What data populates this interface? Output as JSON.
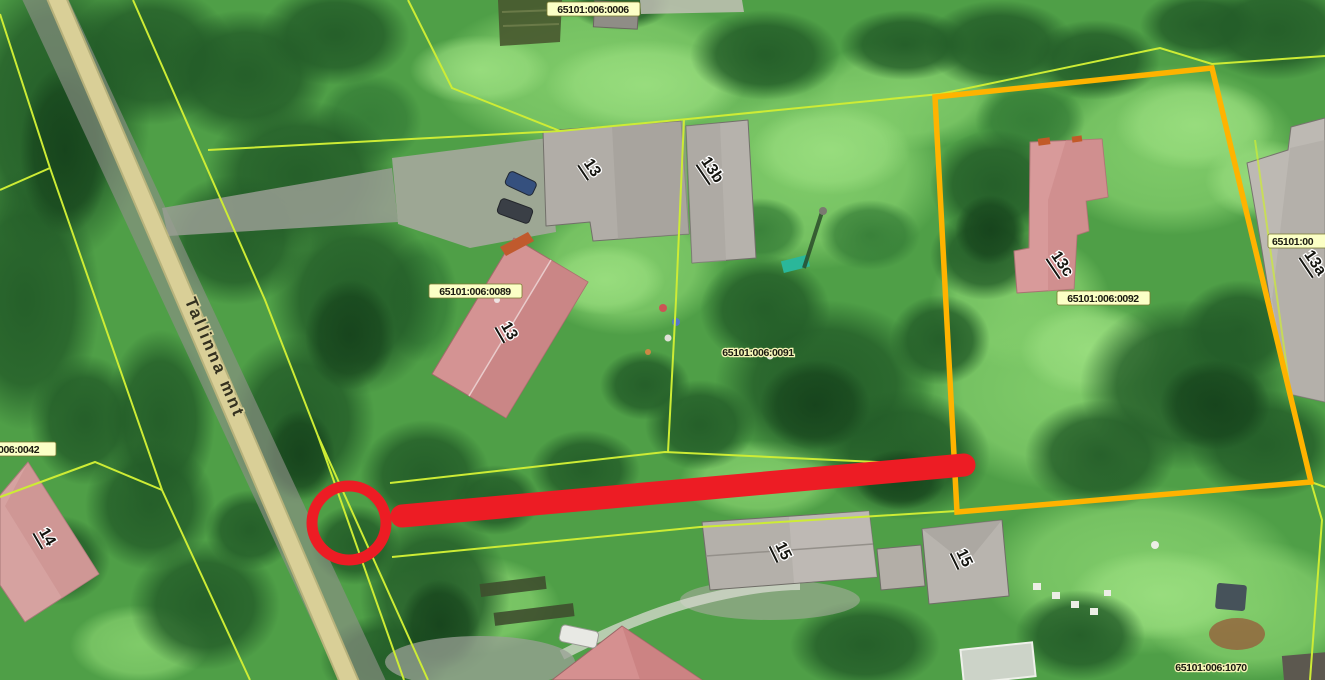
{
  "map": {
    "description": "Aerial cadastral map view (satellite imagery with parcel overlay)",
    "road": {
      "name": "Tallinna mnt"
    },
    "parcel_labels": [
      {
        "code": "65101:006:0006",
        "boxed": true,
        "x": 593,
        "y": 9
      },
      {
        "code": "65101:006:0089",
        "boxed": true,
        "x": 475,
        "y": 291
      },
      {
        "code": "65101:006:0091",
        "boxed": false,
        "x": 758,
        "y": 352
      },
      {
        "code": "65101:006:0092",
        "boxed": true,
        "x": 1103,
        "y": 298
      },
      {
        "code": "65101:00",
        "boxed": true,
        "x": 1295,
        "y": 241,
        "clipped": "right"
      },
      {
        "code": "65101:006:1070",
        "boxed": false,
        "x": 1211,
        "y": 666
      },
      {
        "code": "006:0042",
        "boxed": true,
        "x": 38,
        "y": 450,
        "clipped": "left"
      }
    ],
    "building_labels": [
      {
        "text": "13",
        "x": 592,
        "y": 168
      },
      {
        "text": "13b",
        "x": 712,
        "y": 170
      },
      {
        "text": "13",
        "x": 509,
        "y": 331
      },
      {
        "text": "13c",
        "x": 1062,
        "y": 264
      },
      {
        "text": "13a",
        "x": 1315,
        "y": 263
      },
      {
        "text": "15",
        "x": 783,
        "y": 551
      },
      {
        "text": "15",
        "x": 964,
        "y": 558
      },
      {
        "text": "14",
        "x": 47,
        "y": 537
      }
    ],
    "selected_parcel_outline": {
      "color": "#ffb300",
      "corners": [
        [
          935,
          97
        ],
        [
          1212,
          68
        ],
        [
          1311,
          482
        ],
        [
          957,
          512
        ]
      ]
    },
    "annotation": {
      "type": "red-circle-and-thick-line",
      "color": "#ed1c24",
      "circle_center": [
        349,
        523
      ],
      "circle_radius": 37,
      "line_from": [
        402,
        516
      ],
      "line_to": [
        964,
        465
      ]
    },
    "colors": {
      "parcel_line": "#cdec35",
      "selected_parcel": "#ffb300",
      "annotation_red": "#ed1c24",
      "road_overlay": "#d7cc93",
      "label_background": "#fbffc6"
    }
  }
}
